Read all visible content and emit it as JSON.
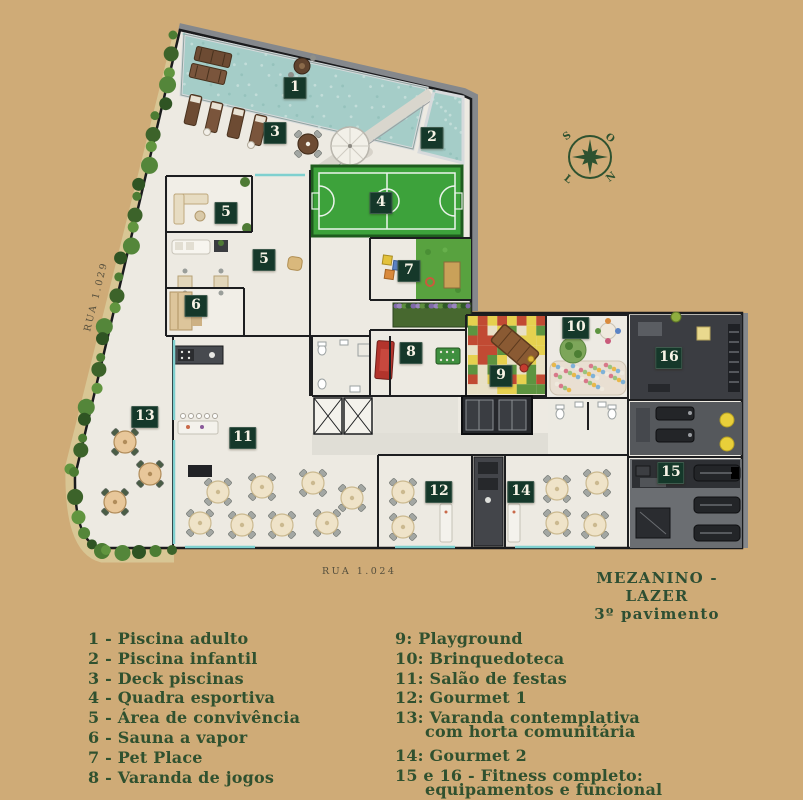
{
  "colors": {
    "background": "#cfab77",
    "ink_green": "#30512f",
    "badge_bg": "#15382a",
    "badge_text": "#f7f3e6",
    "pool_water": "#a5cdc8",
    "court_green": "#3da23b",
    "pet_grass": "#58a23f",
    "hedge_green": "#4c7c33",
    "gym_dark": "#3b3d42",
    "street_text": "#554f3d"
  },
  "title": {
    "line1": "MEZANINO - LAZER",
    "line2": "3º pavimento"
  },
  "streets": {
    "left": "RUA 1.029",
    "bottom": "RUA 1.024"
  },
  "compass": {
    "tl": "S",
    "tr": "O",
    "bl": "L",
    "br": "N"
  },
  "plan_badges": [
    {
      "n": "1",
      "x": 295,
      "y": 88
    },
    {
      "n": "2",
      "x": 432,
      "y": 138
    },
    {
      "n": "3",
      "x": 275,
      "y": 133
    },
    {
      "n": "4",
      "x": 381,
      "y": 203
    },
    {
      "n": "5",
      "x": 226,
      "y": 213
    },
    {
      "n": "5",
      "x": 264,
      "y": 260
    },
    {
      "n": "6",
      "x": 196,
      "y": 306
    },
    {
      "n": "7",
      "x": 409,
      "y": 271
    },
    {
      "n": "8",
      "x": 411,
      "y": 353
    },
    {
      "n": "9",
      "x": 501,
      "y": 376
    },
    {
      "n": "10",
      "x": 576,
      "y": 328
    },
    {
      "n": "11",
      "x": 243,
      "y": 438
    },
    {
      "n": "12",
      "x": 439,
      "y": 492
    },
    {
      "n": "13",
      "x": 145,
      "y": 417
    },
    {
      "n": "14",
      "x": 521,
      "y": 492
    },
    {
      "n": "15",
      "x": 671,
      "y": 473
    },
    {
      "n": "16",
      "x": 669,
      "y": 358
    }
  ],
  "legend": {
    "left": [
      {
        "lines": [
          "1 - Piscina adulto"
        ]
      },
      {
        "lines": [
          "2 - Piscina infantil"
        ]
      },
      {
        "lines": [
          "3 - Deck piscinas"
        ]
      },
      {
        "lines": [
          "4 - Quadra esportiva"
        ]
      },
      {
        "lines": [
          "5 - Área de convivência"
        ]
      },
      {
        "lines": [
          "6 - Sauna a vapor"
        ]
      },
      {
        "lines": [
          "7 - Pet Place"
        ]
      },
      {
        "lines": [
          "8 - Varanda de jogos"
        ]
      }
    ],
    "right": [
      {
        "lines": [
          "9: Playground"
        ]
      },
      {
        "lines": [
          "10: Brinquedoteca"
        ]
      },
      {
        "lines": [
          "11: Salão de festas"
        ]
      },
      {
        "lines": [
          "12: Gourmet 1"
        ]
      },
      {
        "lines": [
          "13: Varanda contemplativa",
          "com horta comunitária"
        ]
      },
      {
        "lines": [
          "14: Gourmet 2"
        ]
      },
      {
        "lines": [
          "15 e 16 - Fitness completo:",
          "equipamentos e funcional"
        ]
      }
    ]
  }
}
